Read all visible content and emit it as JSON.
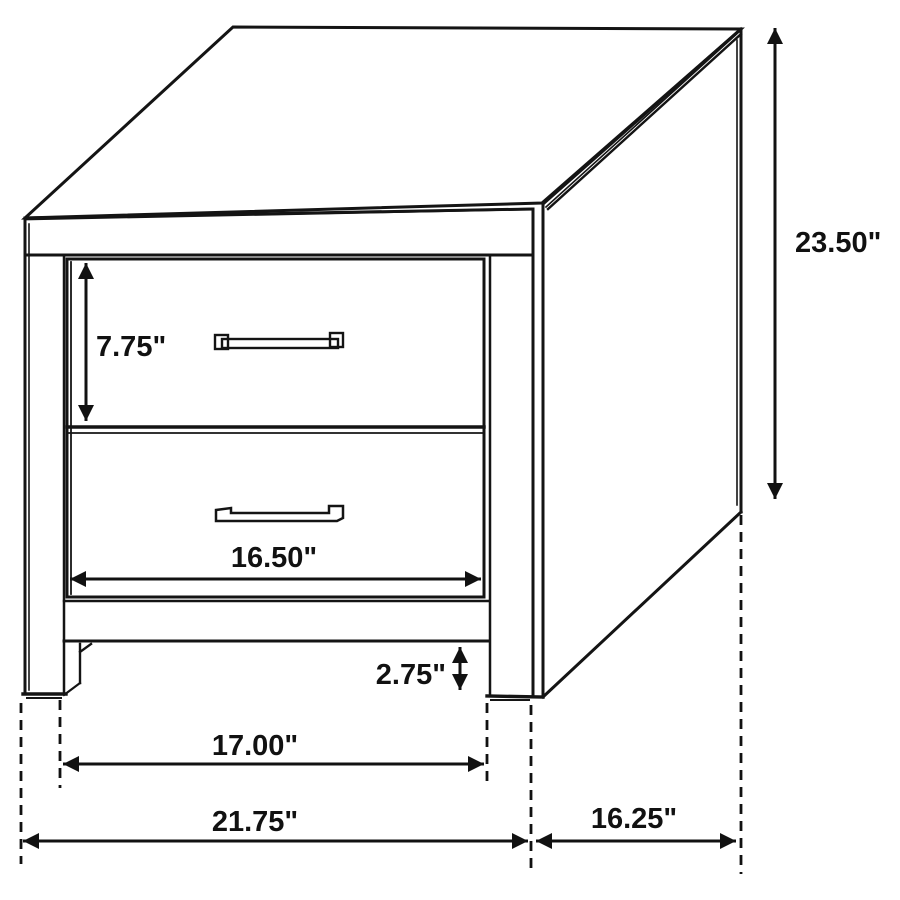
{
  "diagram": {
    "subject": "two-drawer nightstand isometric line drawing with dimension callouts",
    "unit_suffix": "\"",
    "colors": {
      "line": "#111111",
      "background": "#ffffff",
      "shadow_gray": "#9a9a9a"
    },
    "dimensions": {
      "overall_height": "23.50\"",
      "top_drawer_height": "7.75\"",
      "drawer_front_width": "16.50\"",
      "foot_height": "2.75\"",
      "leg_outer_width": "17.00\"",
      "overall_width": "21.75\"",
      "overall_depth": "16.25\""
    }
  }
}
